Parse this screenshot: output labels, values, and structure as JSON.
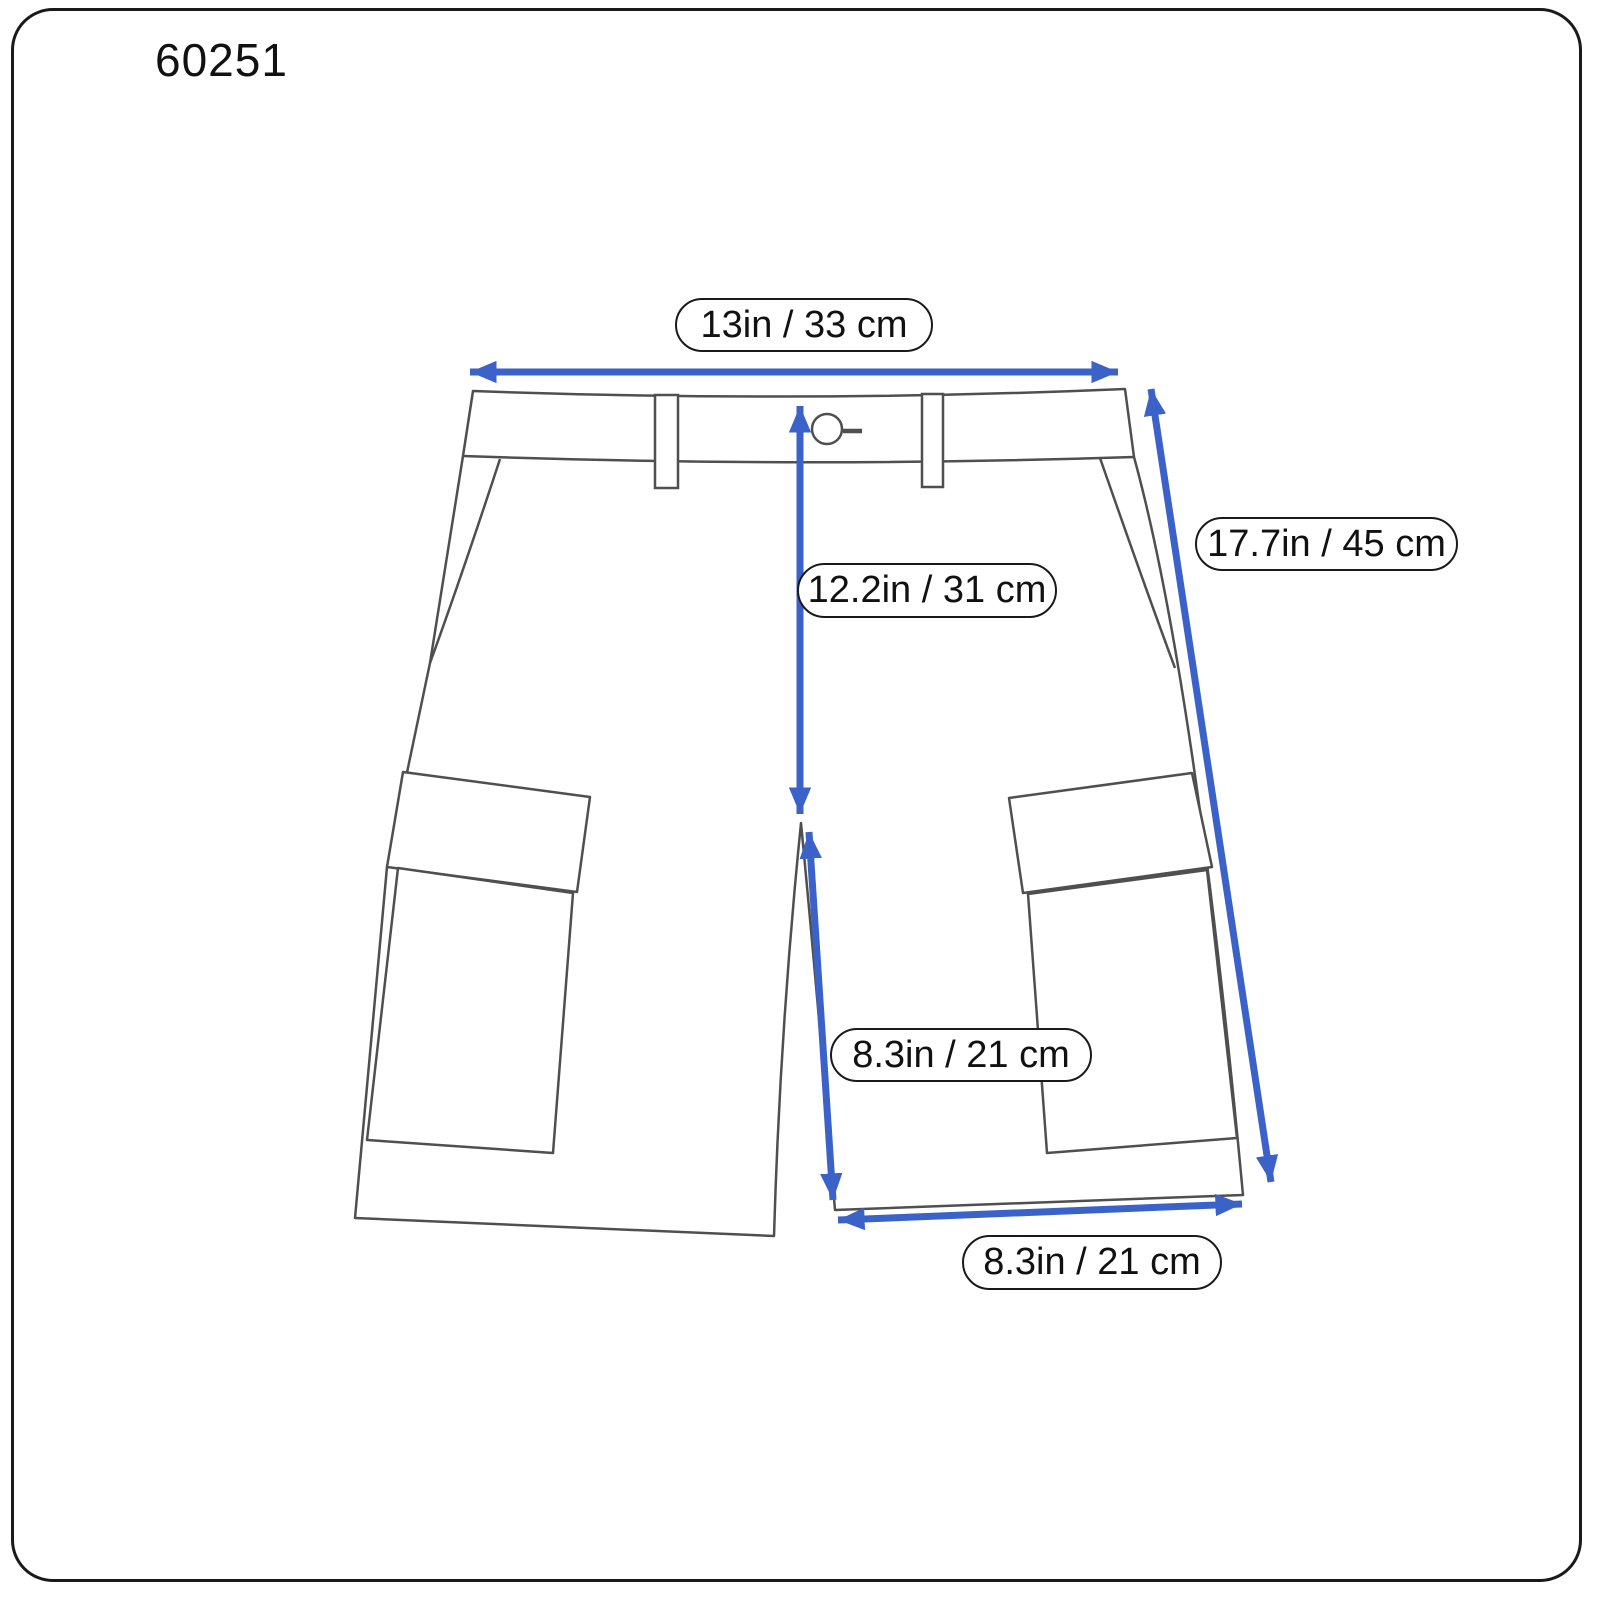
{
  "title": "60251",
  "garment": "cargo-shorts-front-view",
  "colors": {
    "arrow_blue": "#3b62c8",
    "line_gray": "#4f4f4f",
    "pill_border": "#1a1a1a",
    "background": "#ffffff",
    "text": "#111111"
  },
  "measurements": {
    "waist": "13in / 33 cm",
    "side_length": "17.7in / 45 cm",
    "front_rise": "12.2in / 31 cm",
    "inseam": "8.3in / 21 cm",
    "hem_opening": "8.3in / 21 cm"
  }
}
